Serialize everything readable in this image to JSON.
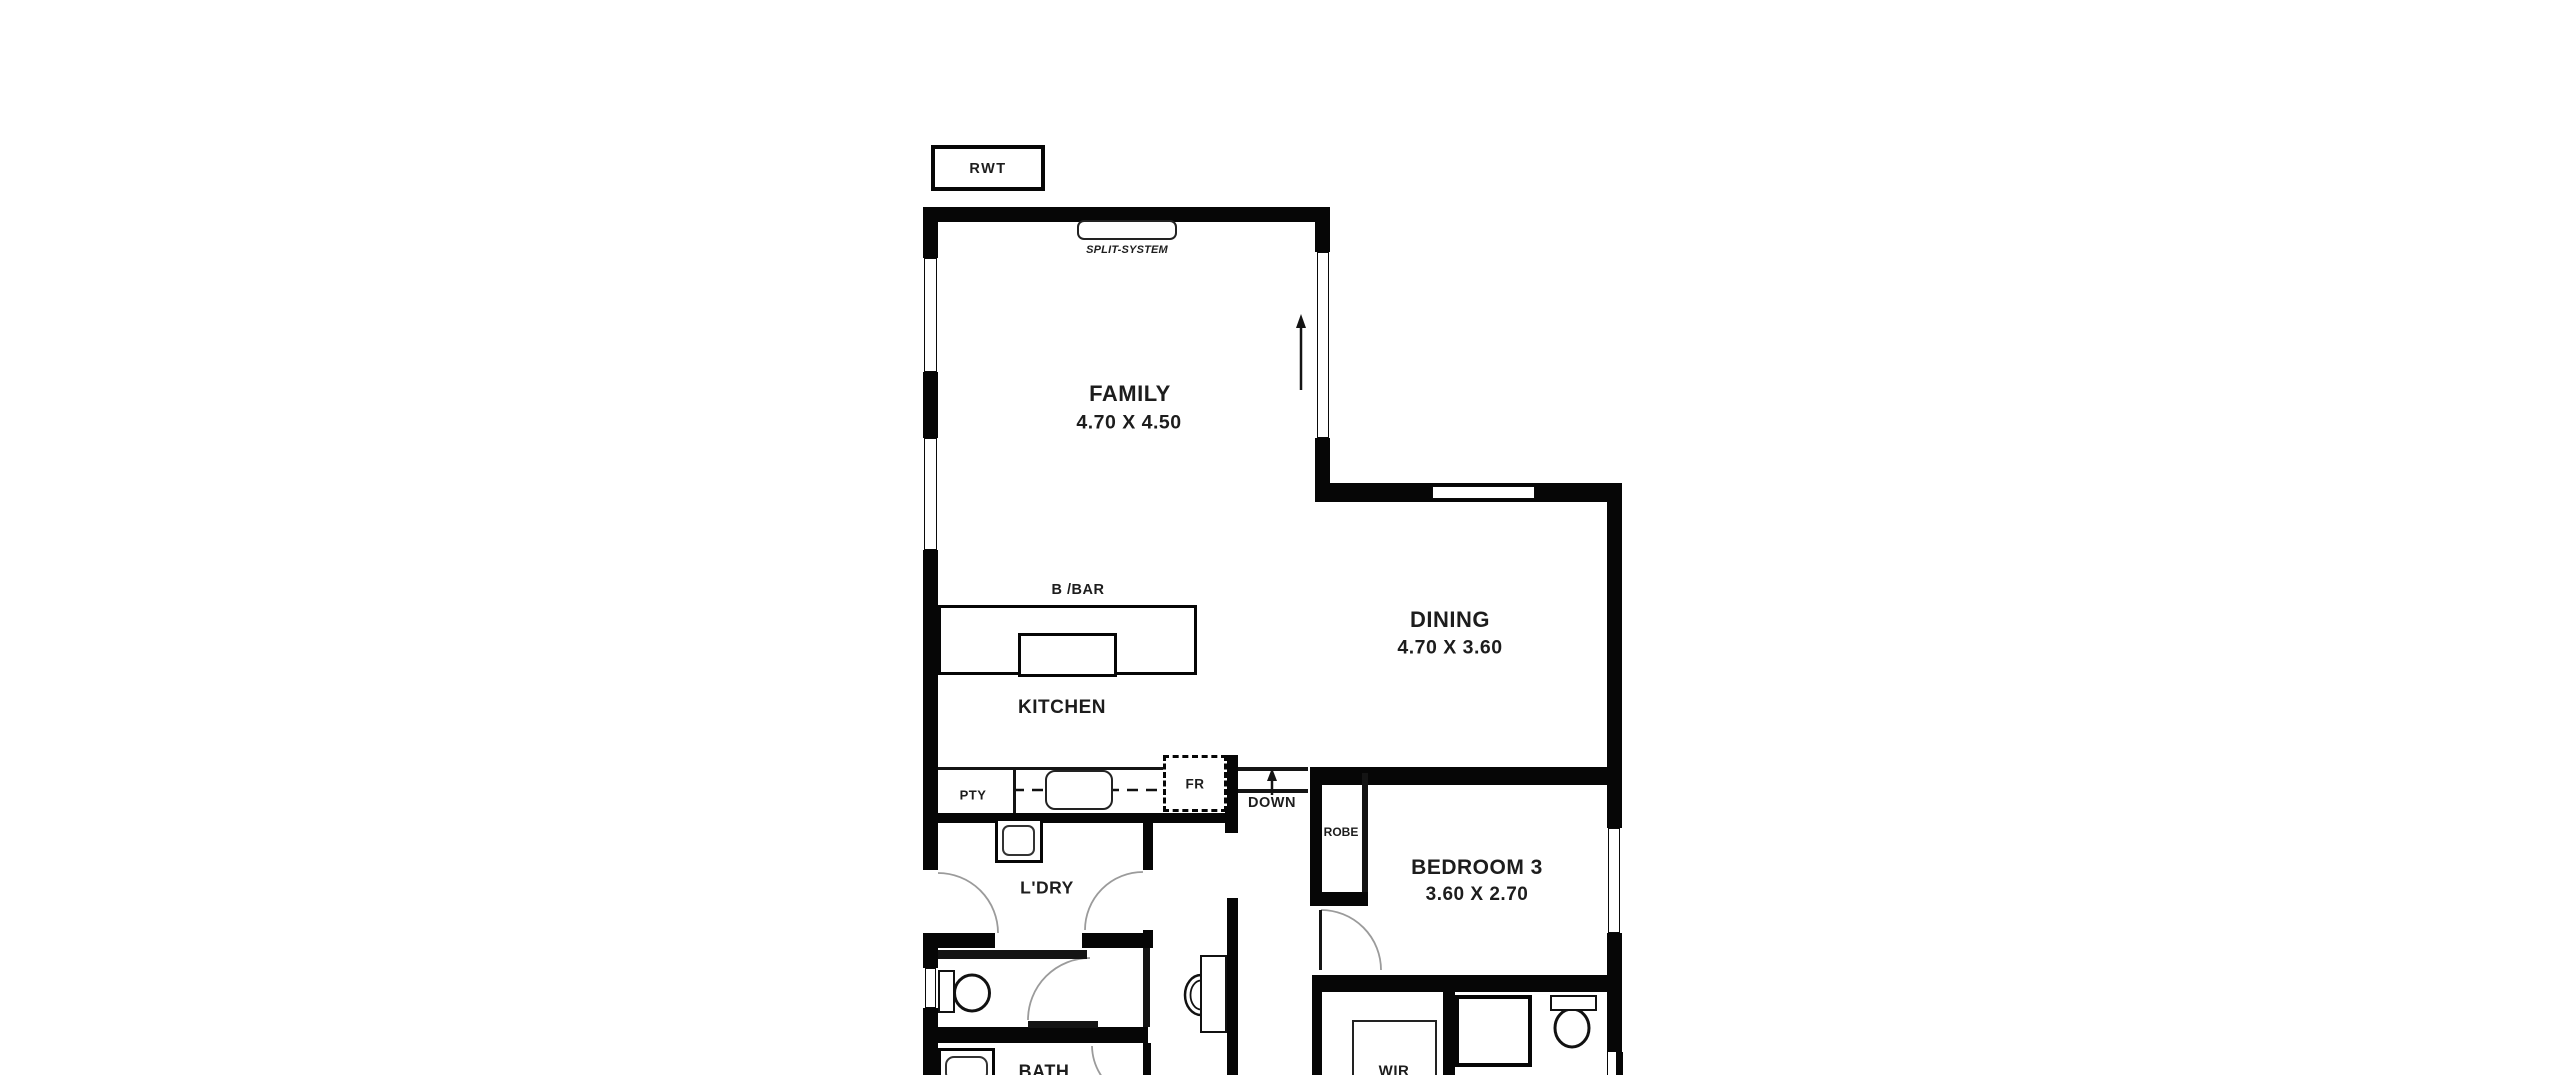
{
  "title": "Floor plan",
  "labels": {
    "rwt": "RWT",
    "split_system": "SPLIT-SYSTEM",
    "family": {
      "name": "FAMILY",
      "dims": "4.70 X 4.50"
    },
    "dining": {
      "name": "DINING",
      "dims": "4.70 X 3.60"
    },
    "bedroom3": {
      "name": "BEDROOM 3",
      "dims": "3.60 X 2.70"
    },
    "kitchen": "KITCHEN",
    "bbar": "B /BAR",
    "pty": "PTY",
    "fr": "FR",
    "down": "DOWN",
    "ldry": "L'DRY",
    "robe": "ROBE",
    "bath": "BATH",
    "wir": "WIR"
  },
  "icons": [
    "split-system-unit-icon",
    "kitchen-sink-icon",
    "cooktop-icon",
    "laundry-trough-icon",
    "toilet-icon",
    "ensuite-toilet-icon",
    "vanity-basin-icon",
    "shower-icon",
    "bathtub-icon",
    "stair-down-arrow-icon",
    "north-flow-arrow-icon",
    "door-swing-arc-icon",
    "window-icon"
  ],
  "colors": {
    "background": "#ffffff",
    "walls": "#060606",
    "text": "#1d1d1d",
    "door_arc": "#9b9b9b",
    "fixture_line": "#222222"
  }
}
